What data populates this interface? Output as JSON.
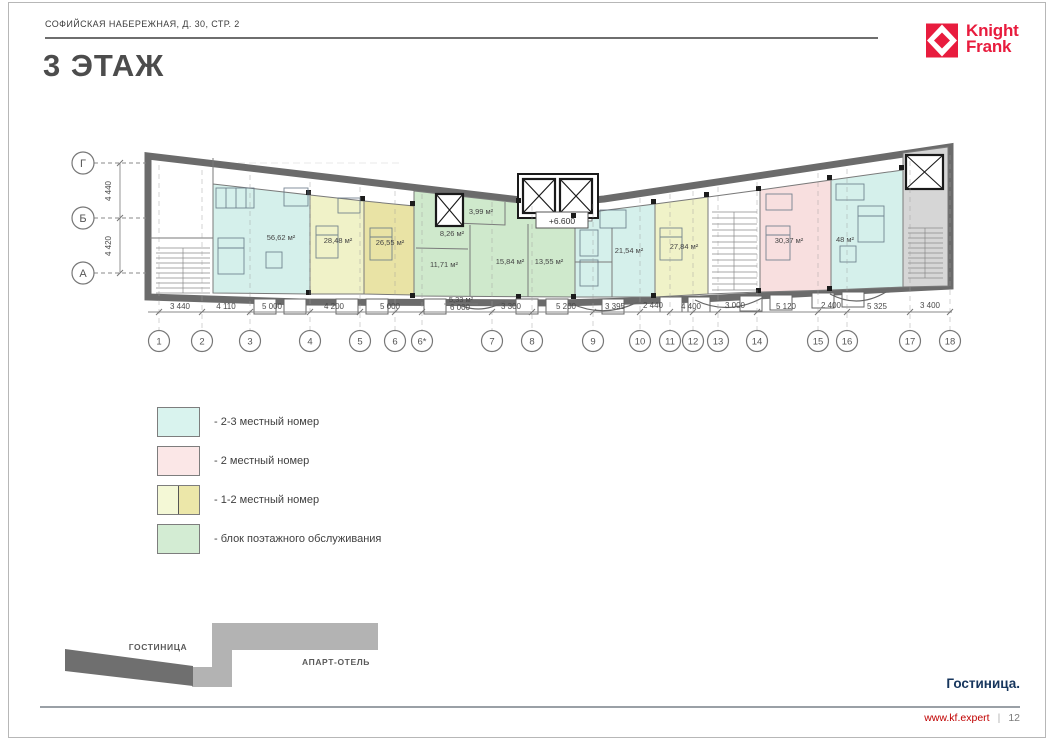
{
  "header": {
    "address": "СОФИЙСКАЯ НАБЕРЕЖНАЯ, Д. 30, СТР. 2",
    "title": "3 ЭТАЖ"
  },
  "logo": {
    "line1": "Knight",
    "line2": "Frank",
    "brand_color": "#e81c3e"
  },
  "plan": {
    "elevation": "+6.600",
    "axes": [
      "Г",
      "Б",
      "А"
    ],
    "vertical_dims": [
      "4 440",
      "4 420"
    ],
    "columns": [
      "1",
      "2",
      "3",
      "4",
      "5",
      "6",
      "6*",
      "7",
      "8",
      "9",
      "10",
      "11",
      "12",
      "13",
      "14",
      "15",
      "16",
      "17",
      "18"
    ],
    "dimensions": [
      "3 440",
      "4 110",
      "5 000",
      "4 200",
      "5 000",
      "6 000",
      "3 300",
      "5 200",
      "3 395",
      "2 440",
      "4 400",
      "3 000",
      "5 120",
      "2 400",
      "5 325",
      "3 400"
    ],
    "rooms": [
      {
        "area": "56,62 м²",
        "fill": "#d5f0eb"
      },
      {
        "area": "28,48 м²",
        "fill": "#f0f2c8"
      },
      {
        "area": "26,55 м²",
        "fill": "#e9e3a5"
      },
      {
        "area": "8,26 м²",
        "fill": "#cfe9cc"
      },
      {
        "area": "3,99 м²",
        "fill": "#cfe9cc"
      },
      {
        "area": "11,71 м²",
        "fill": "#cfe9cc"
      },
      {
        "area": "15,84 м²",
        "fill": "#cfe9cc"
      },
      {
        "area": "13,55 м²",
        "fill": "#cfe9cc"
      },
      {
        "area": "5,33 м²",
        "fill": "#cfe9cc"
      },
      {
        "area": "21,54 м²",
        "fill": "#d5f0eb"
      },
      {
        "area": "27,84 м²",
        "fill": "#f0f2c8"
      },
      {
        "area": "30,37 м²",
        "fill": "#f8dfdf"
      },
      {
        "area": "48 м²",
        "fill": "#d5f0eb"
      }
    ]
  },
  "legend": {
    "items": [
      {
        "label": "- 2-3 местный номер",
        "color": "#d9f3ee"
      },
      {
        "label": "- 2 местный номер",
        "color": "#fbe7e7"
      },
      {
        "label": "- 1-2 местный номер",
        "colors": [
          "#f4f8d6",
          "#ece7a9"
        ]
      },
      {
        "label": "- блок поэтажного обслуживания",
        "color": "#d3ecd3"
      }
    ]
  },
  "site_map": {
    "hotel": "ГОСТИНИЦА",
    "apart": "АПАРТ-ОТЕЛЬ"
  },
  "footer": {
    "section": "Гостиница.",
    "url": "www.kf.expert",
    "separator": "|",
    "page": "12"
  }
}
